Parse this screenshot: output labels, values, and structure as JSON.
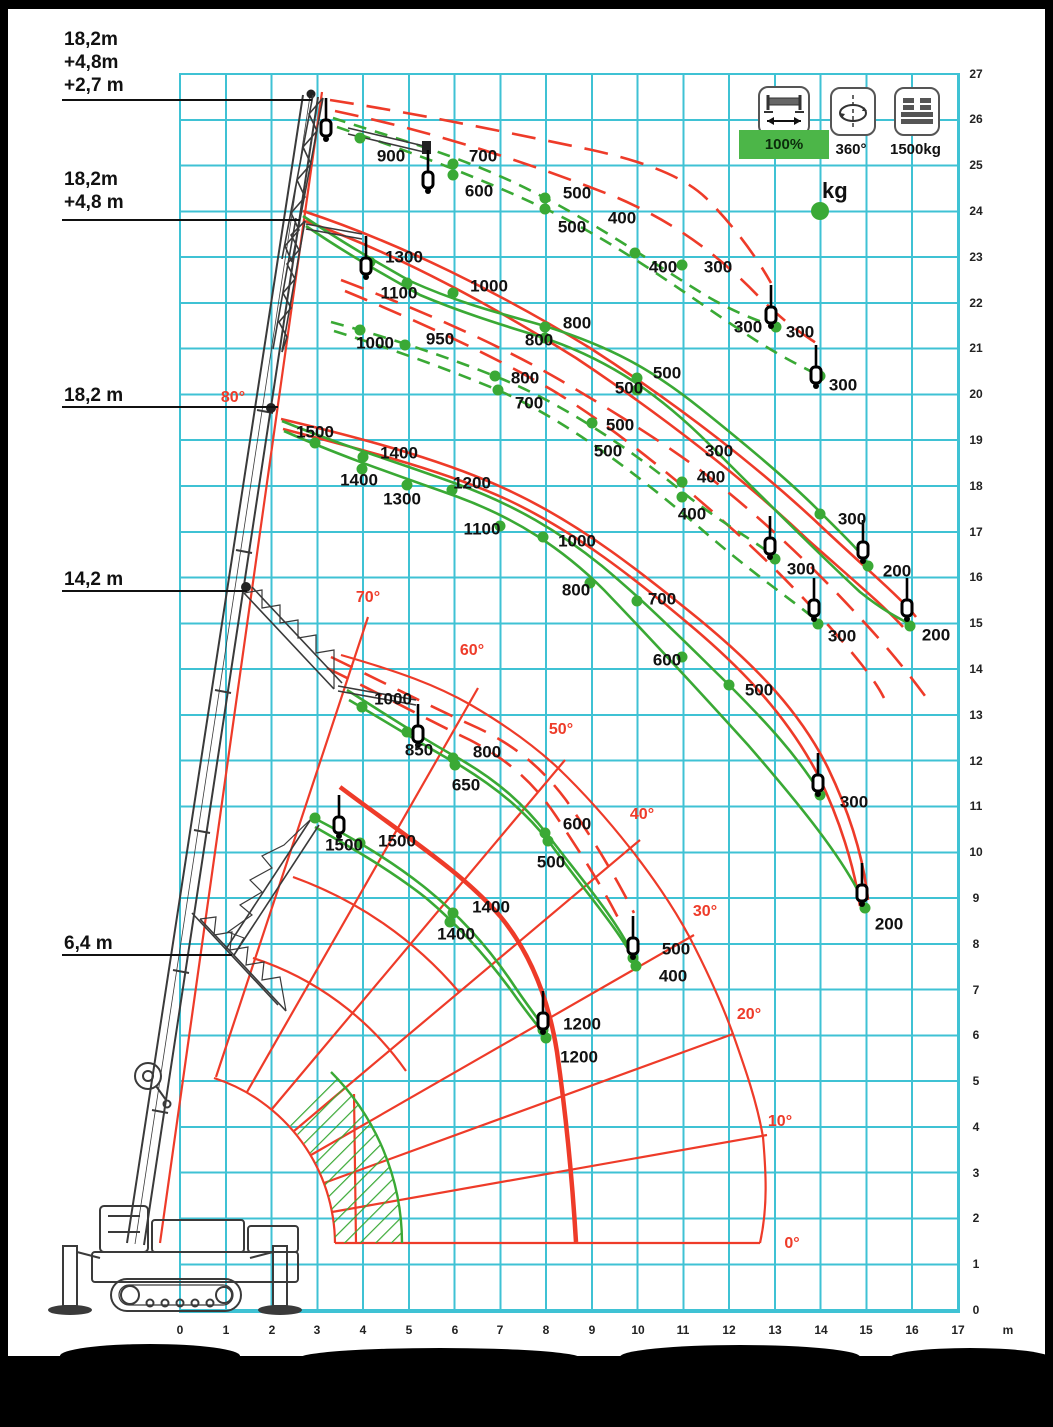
{
  "colors": {
    "green": "#3aa935",
    "red": "#ee3b29",
    "grid": "#3fc2d4",
    "badge_green": "#4cb648"
  },
  "legend": {
    "outrigger_label": "100%",
    "slew_label": "360°",
    "counterweight_label": "1500kg",
    "unit_label": "kg"
  },
  "boom_labels": [
    {
      "lines": [
        "18,2m",
        "+4,8m",
        "+2,7 m"
      ]
    },
    {
      "lines": [
        "18,2m",
        "+4,8 m"
      ]
    },
    {
      "lines": [
        "18,2 m"
      ]
    },
    {
      "lines": [
        "14,2 m"
      ]
    },
    {
      "lines": [
        "6,4 m"
      ]
    }
  ],
  "axes": {
    "x_unit": "m",
    "x": [
      {
        "t": "0",
        "x": 180
      },
      {
        "t": "1",
        "x": 226
      },
      {
        "t": "2",
        "x": 272
      },
      {
        "t": "3",
        "x": 317
      },
      {
        "t": "4",
        "x": 363
      },
      {
        "t": "5",
        "x": 409
      },
      {
        "t": "6",
        "x": 455
      },
      {
        "t": "7",
        "x": 500
      },
      {
        "t": "8",
        "x": 546
      },
      {
        "t": "9",
        "x": 592
      },
      {
        "t": "10",
        "x": 638
      },
      {
        "t": "11",
        "x": 683
      },
      {
        "t": "12",
        "x": 729
      },
      {
        "t": "13",
        "x": 775
      },
      {
        "t": "14",
        "x": 821
      },
      {
        "t": "15",
        "x": 866
      },
      {
        "t": "16",
        "x": 912
      },
      {
        "t": "17",
        "x": 958
      }
    ],
    "y": [
      {
        "t": "0",
        "y": 1310
      },
      {
        "t": "1",
        "y": 1264
      },
      {
        "t": "2",
        "y": 1218
      },
      {
        "t": "3",
        "y": 1173
      },
      {
        "t": "4",
        "y": 1127
      },
      {
        "t": "5",
        "y": 1081
      },
      {
        "t": "6",
        "y": 1035
      },
      {
        "t": "7",
        "y": 990
      },
      {
        "t": "8",
        "y": 944
      },
      {
        "t": "9",
        "y": 898
      },
      {
        "t": "10",
        "y": 852
      },
      {
        "t": "11",
        "y": 806
      },
      {
        "t": "12",
        "y": 761
      },
      {
        "t": "13",
        "y": 715
      },
      {
        "t": "14",
        "y": 669
      },
      {
        "t": "15",
        "y": 623
      },
      {
        "t": "16",
        "y": 577
      },
      {
        "t": "17",
        "y": 532
      },
      {
        "t": "18",
        "y": 486
      },
      {
        "t": "19",
        "y": 440
      },
      {
        "t": "20",
        "y": 394
      },
      {
        "t": "21",
        "y": 348
      },
      {
        "t": "22",
        "y": 303
      },
      {
        "t": "23",
        "y": 257
      },
      {
        "t": "24",
        "y": 211
      },
      {
        "t": "25",
        "y": 165
      },
      {
        "t": "26",
        "y": 119
      },
      {
        "t": "27",
        "y": 74
      }
    ]
  },
  "chart_data": {
    "type": "line",
    "title": "Crane working range / load capacity diagram",
    "xlabel": "outreach (m)",
    "ylabel": "height (m)",
    "xlim": [
      0,
      17
    ],
    "ylim": [
      0,
      27
    ],
    "grid": true,
    "outrigger": "100%",
    "slew": "360°",
    "counterweight": "1500kg",
    "load_unit": "kg",
    "boom_angles_deg": [
      0,
      10,
      20,
      30,
      40,
      50,
      60,
      70,
      80
    ],
    "series": [
      {
        "name": "18,2m +4,8m +2,7 m (jib, dashed)",
        "style": "green-dashed",
        "points": [
          [
            900,
            3.9,
            25.6
          ],
          [
            700,
            6.0,
            25.0
          ],
          [
            600,
            6.0,
            24.8
          ],
          [
            500,
            8.0,
            24.3
          ],
          [
            500,
            8.0,
            24.1
          ],
          [
            400,
            9.9,
            23.1
          ],
          [
            400,
            11.0,
            22.8
          ],
          [
            300,
            13.0,
            21.5
          ],
          [
            300,
            14.0,
            20.4
          ]
        ]
      },
      {
        "name": "18,2m +4,8 m (jib, dashed)",
        "style": "green-dashed",
        "points": [
          [
            1000,
            3.9,
            21.4
          ],
          [
            950,
            4.9,
            21.1
          ],
          [
            800,
            6.9,
            20.4
          ],
          [
            700,
            7.0,
            20.1
          ],
          [
            500,
            9.0,
            19.4
          ],
          [
            400,
            11.0,
            18.1
          ],
          [
            400,
            11.0,
            17.8
          ],
          [
            300,
            13.0,
            16.4
          ],
          [
            300,
            13.9,
            15.0
          ]
        ]
      },
      {
        "name": "18,2m +4,8 m (solid)",
        "style": "green-solid",
        "points": [
          [
            1300,
            4.2,
            22.9
          ],
          [
            1100,
            5.0,
            22.4
          ],
          [
            1000,
            6.0,
            22.2
          ],
          [
            800,
            8.0,
            21.5
          ],
          [
            800,
            8.0,
            21.2
          ],
          [
            500,
            10.0,
            20.4
          ],
          [
            500,
            10.0,
            20.1
          ],
          [
            300,
            14.0,
            17.4
          ],
          [
            200,
            15.0,
            16.3
          ],
          [
            200,
            16.0,
            14.9
          ]
        ]
      },
      {
        "name": "18,2 m",
        "style": "green-solid",
        "points": [
          [
            1500,
            3.0,
            18.9
          ],
          [
            1400,
            4.0,
            18.6
          ],
          [
            1400,
            4.0,
            18.4
          ],
          [
            1300,
            5.0,
            18.0
          ],
          [
            1200,
            5.9,
            17.9
          ],
          [
            1100,
            7.0,
            17.1
          ],
          [
            1000,
            7.9,
            16.9
          ],
          [
            800,
            9.0,
            15.9
          ],
          [
            700,
            10.0,
            15.5
          ],
          [
            600,
            11.0,
            14.3
          ],
          [
            500,
            12.0,
            13.7
          ],
          [
            300,
            14.0,
            11.3
          ],
          [
            200,
            15.0,
            8.8
          ]
        ]
      },
      {
        "name": "14,2 m (jib)",
        "style": "green-solid",
        "points": [
          [
            1000,
            4.0,
            13.2
          ],
          [
            850,
            5.0,
            12.6
          ],
          [
            800,
            6.0,
            12.1
          ],
          [
            650,
            6.0,
            11.9
          ],
          [
            600,
            8.0,
            10.4
          ],
          [
            500,
            8.0,
            10.2
          ],
          [
            500,
            9.9,
            7.7
          ],
          [
            400,
            10.0,
            7.5
          ]
        ]
      },
      {
        "name": "6,4 m",
        "style": "green-solid",
        "points": [
          [
            1500,
            3.9,
            10.2
          ],
          [
            1500,
            4.4,
            10.3
          ],
          [
            1400,
            6.0,
            8.7
          ],
          [
            1400,
            5.9,
            8.5
          ],
          [
            1200,
            7.9,
            6.1
          ],
          [
            1200,
            8.0,
            5.9
          ]
        ]
      }
    ]
  },
  "overlay": {
    "labels": [
      {
        "t": "900",
        "x": 391,
        "y": 156
      },
      {
        "t": "700",
        "x": 483,
        "y": 156
      },
      {
        "t": "600",
        "x": 479,
        "y": 191
      },
      {
        "t": "500",
        "x": 577,
        "y": 193
      },
      {
        "t": "500",
        "x": 572,
        "y": 227
      },
      {
        "t": "400",
        "x": 622,
        "y": 218
      },
      {
        "t": "400",
        "x": 663,
        "y": 267
      },
      {
        "t": "300",
        "x": 718,
        "y": 267
      },
      {
        "t": "300",
        "x": 748,
        "y": 327
      },
      {
        "t": "300",
        "x": 800,
        "y": 332
      },
      {
        "t": "300",
        "x": 843,
        "y": 385
      },
      {
        "t": "1300",
        "x": 404,
        "y": 257
      },
      {
        "t": "1100",
        "x": 399,
        "y": 293
      },
      {
        "t": "1000",
        "x": 489,
        "y": 286
      },
      {
        "t": "1000",
        "x": 375,
        "y": 343
      },
      {
        "t": "950",
        "x": 440,
        "y": 339
      },
      {
        "t": "800",
        "x": 577,
        "y": 323
      },
      {
        "t": "800",
        "x": 539,
        "y": 340
      },
      {
        "t": "800",
        "x": 525,
        "y": 378
      },
      {
        "t": "700",
        "x": 529,
        "y": 403
      },
      {
        "t": "500",
        "x": 667,
        "y": 373
      },
      {
        "t": "500",
        "x": 629,
        "y": 388
      },
      {
        "t": "500",
        "x": 620,
        "y": 425
      },
      {
        "t": "500",
        "x": 608,
        "y": 451
      },
      {
        "t": "300",
        "x": 719,
        "y": 451
      },
      {
        "t": "400",
        "x": 711,
        "y": 477
      },
      {
        "t": "400",
        "x": 692,
        "y": 514
      },
      {
        "t": "300",
        "x": 801,
        "y": 569
      },
      {
        "t": "300",
        "x": 842,
        "y": 636
      },
      {
        "t": "200",
        "x": 897,
        "y": 571
      },
      {
        "t": "200",
        "x": 936,
        "y": 635
      },
      {
        "t": "300",
        "x": 852,
        "y": 519
      },
      {
        "t": "1500",
        "x": 315,
        "y": 432
      },
      {
        "t": "1400",
        "x": 399,
        "y": 453
      },
      {
        "t": "1400",
        "x": 359,
        "y": 480
      },
      {
        "t": "1300",
        "x": 402,
        "y": 499
      },
      {
        "t": "1200",
        "x": 472,
        "y": 483
      },
      {
        "t": "1100",
        "x": 482,
        "y": 529
      },
      {
        "t": "1000",
        "x": 577,
        "y": 541
      },
      {
        "t": "800",
        "x": 576,
        "y": 590
      },
      {
        "t": "700",
        "x": 662,
        "y": 599
      },
      {
        "t": "600",
        "x": 667,
        "y": 660
      },
      {
        "t": "500",
        "x": 759,
        "y": 690
      },
      {
        "t": "300",
        "x": 854,
        "y": 802
      },
      {
        "t": "200",
        "x": 889,
        "y": 924
      },
      {
        "t": "1000",
        "x": 393,
        "y": 699
      },
      {
        "t": "850",
        "x": 419,
        "y": 750
      },
      {
        "t": "800",
        "x": 487,
        "y": 752
      },
      {
        "t": "650",
        "x": 466,
        "y": 785
      },
      {
        "t": "600",
        "x": 577,
        "y": 824
      },
      {
        "t": "500",
        "x": 551,
        "y": 862
      },
      {
        "t": "500",
        "x": 676,
        "y": 949
      },
      {
        "t": "400",
        "x": 673,
        "y": 976
      },
      {
        "t": "1500",
        "x": 344,
        "y": 845
      },
      {
        "t": "1500",
        "x": 397,
        "y": 841
      },
      {
        "t": "1400",
        "x": 491,
        "y": 907
      },
      {
        "t": "1400",
        "x": 456,
        "y": 934
      },
      {
        "t": "1200",
        "x": 582,
        "y": 1024
      },
      {
        "t": "1200",
        "x": 579,
        "y": 1057
      },
      {
        "t": "80°",
        "x": 233,
        "y": 398,
        "k": "angle"
      },
      {
        "t": "70°",
        "x": 368,
        "y": 598,
        "k": "angle"
      },
      {
        "t": "60°",
        "x": 472,
        "y": 651,
        "k": "angle"
      },
      {
        "t": "50°",
        "x": 561,
        "y": 730,
        "k": "angle"
      },
      {
        "t": "40°",
        "x": 642,
        "y": 815,
        "k": "angle"
      },
      {
        "t": "30°",
        "x": 705,
        "y": 912,
        "k": "angle"
      },
      {
        "t": "20°",
        "x": 749,
        "y": 1015,
        "k": "angle"
      },
      {
        "t": "10°",
        "x": 780,
        "y": 1122,
        "k": "angle"
      },
      {
        "t": "0°",
        "x": 792,
        "y": 1244,
        "k": "angle"
      }
    ],
    "dots": [
      [
        360,
        138
      ],
      [
        453,
        164
      ],
      [
        453,
        175
      ],
      [
        545,
        198
      ],
      [
        545,
        209
      ],
      [
        635,
        253
      ],
      [
        682,
        265
      ],
      [
        776,
        327
      ],
      [
        820,
        376
      ],
      [
        360,
        330
      ],
      [
        405,
        345
      ],
      [
        495,
        376
      ],
      [
        498,
        390
      ],
      [
        592,
        423
      ],
      [
        682,
        482
      ],
      [
        682,
        497
      ],
      [
        775,
        559
      ],
      [
        818,
        624
      ],
      [
        370,
        262
      ],
      [
        407,
        283
      ],
      [
        453,
        293
      ],
      [
        545,
        327
      ],
      [
        545,
        338
      ],
      [
        637,
        378
      ],
      [
        637,
        390
      ],
      [
        820,
        514
      ],
      [
        868,
        566
      ],
      [
        910,
        626
      ],
      [
        315,
        443
      ],
      [
        363,
        457
      ],
      [
        362,
        469
      ],
      [
        407,
        485
      ],
      [
        452,
        490
      ],
      [
        500,
        526
      ],
      [
        543,
        537
      ],
      [
        590,
        583
      ],
      [
        637,
        601
      ],
      [
        682,
        657
      ],
      [
        729,
        685
      ],
      [
        820,
        795
      ],
      [
        865,
        908
      ],
      [
        362,
        707
      ],
      [
        407,
        732
      ],
      [
        453,
        758
      ],
      [
        455,
        765
      ],
      [
        545,
        833
      ],
      [
        548,
        841
      ],
      [
        633,
        958
      ],
      [
        636,
        966
      ],
      [
        315,
        818
      ],
      [
        360,
        843
      ],
      [
        453,
        913
      ],
      [
        450,
        922
      ],
      [
        543,
        1030
      ],
      [
        546,
        1038
      ],
      [
        820,
        211,
        9
      ]
    ],
    "hooks": [
      [
        326,
        98
      ],
      [
        428,
        150
      ],
      [
        366,
        236
      ],
      [
        771,
        285
      ],
      [
        816,
        345
      ],
      [
        770,
        516
      ],
      [
        863,
        520
      ],
      [
        814,
        578
      ],
      [
        907,
        578
      ],
      [
        818,
        753
      ],
      [
        862,
        863
      ],
      [
        418,
        704
      ],
      [
        339,
        795
      ],
      [
        633,
        916
      ],
      [
        543,
        991
      ]
    ]
  }
}
